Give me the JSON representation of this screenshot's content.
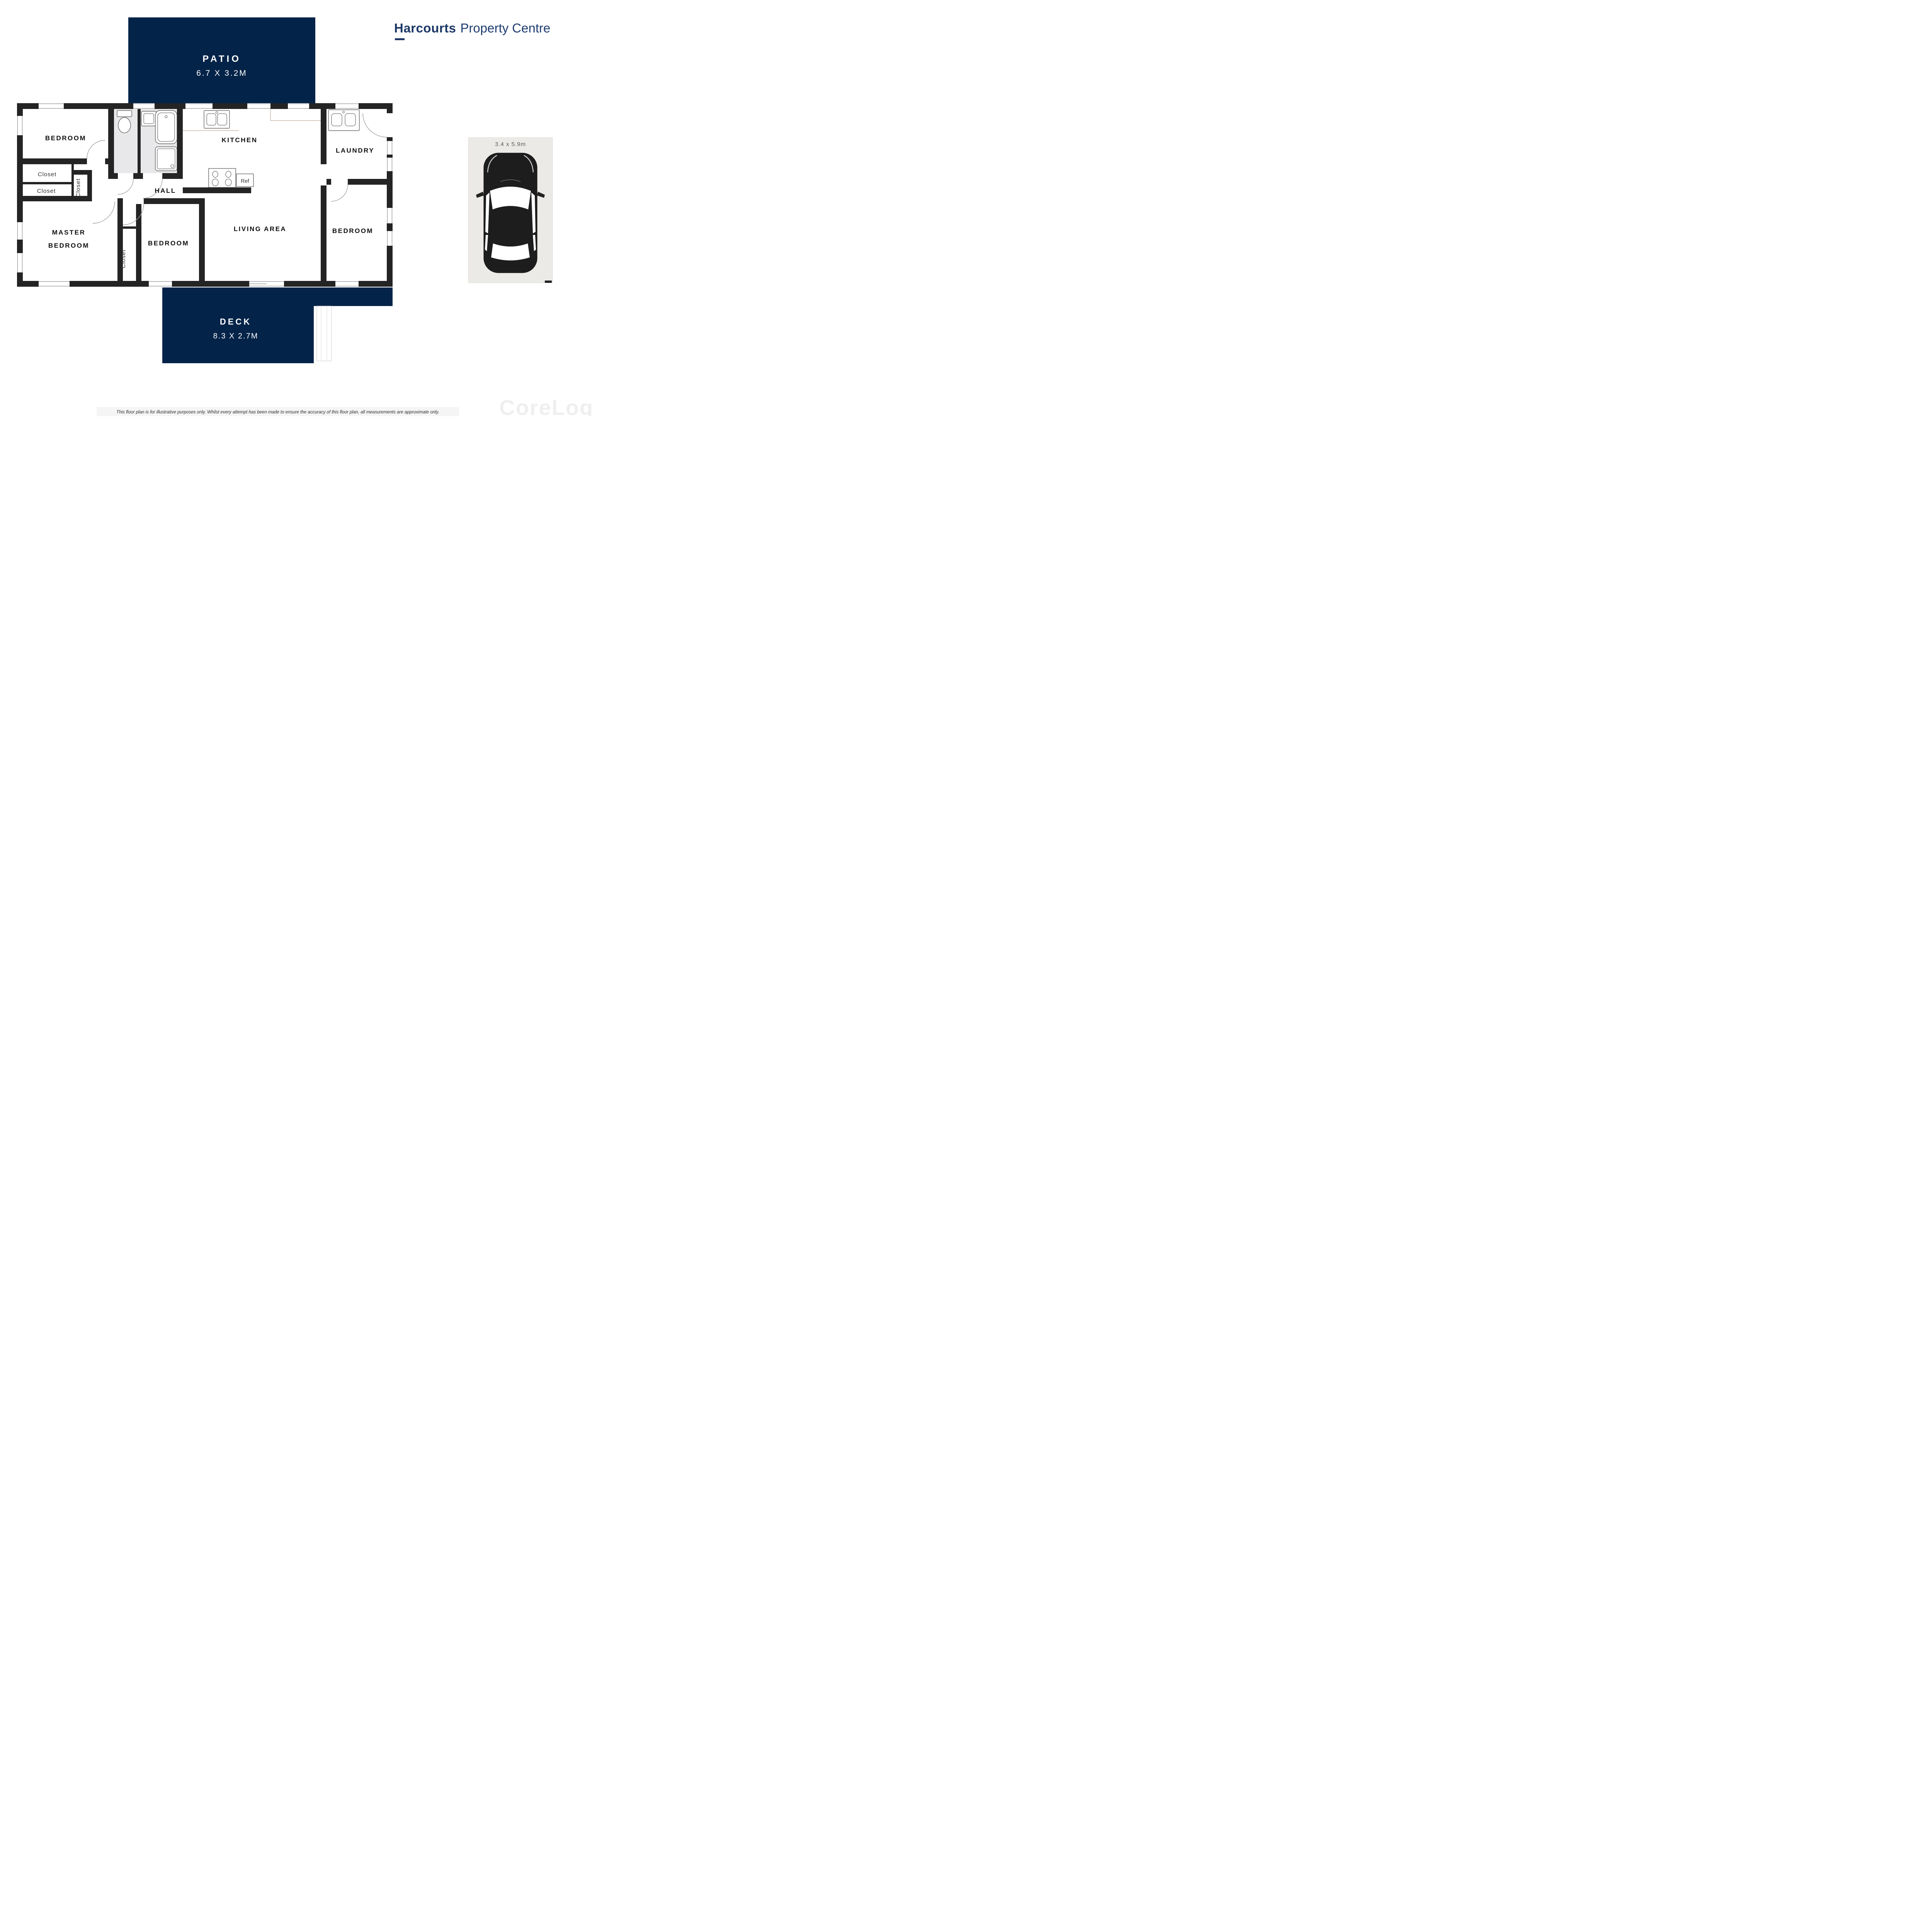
{
  "brand": {
    "name_bold": "Harcourts",
    "name_light": "Property Centre"
  },
  "patio": {
    "label": "PATIO",
    "dims": "6.7 X 3.2M"
  },
  "deck": {
    "label": "DECK",
    "dims": "8.3 X 2.7M"
  },
  "carport": {
    "dims": "3.4 x 5.9m",
    "icon": "car-top-view-icon"
  },
  "rooms": {
    "bedroom_top_left": "BEDROOM",
    "closet_1": "Closet",
    "closet_2": "Closet",
    "closet_vertical": "Closet",
    "master_line1": "MASTER",
    "master_line2": "BEDROOM",
    "closet_mid_vertical": "Closet",
    "bedroom_mid": "BEDROOM",
    "hall": "HALL",
    "kitchen": "KITCHEN",
    "ref": "Ref",
    "laundry": "LAUNDRY",
    "living": "LIVING AREA",
    "bedroom_right": "BEDROOM"
  },
  "icons": {
    "toilet": "toilet-icon",
    "bathtub": "bathtub-icon",
    "shower": "shower-icon",
    "bath_sink": "sink-icon",
    "kitchen_sink": "double-sink-icon",
    "laundry_sink": "double-sink-icon",
    "stove": "stove-burners-icon",
    "car": "car-top-view-icon"
  },
  "agents": [
    {
      "name": "ALEX STASSEN",
      "phone": "0401 801 728"
    },
    {
      "name": "ROWENA GILL",
      "phone": "0411 166 622"
    }
  ],
  "disclaimer": {
    "line1": "This floor plan is for illustrative purposes only. Whilst every attempt has been made to ensure the accuracy of this floor plan, all measurements are approximate only.",
    "line2": "No responsibility is taken for any errors, omission or miss-statement. Potential purchasers should make their own enquiries as to the accuracy of this floor plan."
  },
  "watermark": "CoreLogic",
  "colors": {
    "navy": "#032348",
    "brand-navy": "#1c3866",
    "wall": "#242424",
    "tile": "#e8e8ea",
    "carport": "#eceae6"
  }
}
